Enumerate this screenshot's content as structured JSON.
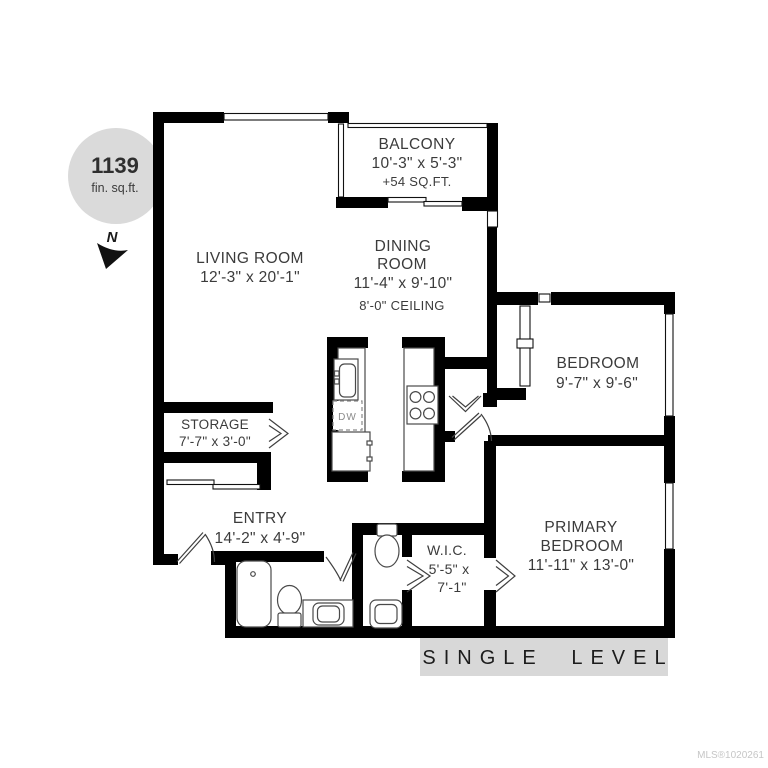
{
  "badge": {
    "area": "1139",
    "unit": "fin. sq.ft."
  },
  "compass": {
    "north": "N"
  },
  "rooms": {
    "balcony": {
      "name": "BALCONY",
      "dims": "10'-3\" x 5'-3\"",
      "extra": "+54 SQ.FT."
    },
    "living_room": {
      "name": "LIVING ROOM",
      "dims": "12'-3\" x 20'-1\""
    },
    "dining_room": {
      "name_line1": "DINING",
      "name_line2": "ROOM",
      "dims": "11'-4\" x 9'-10\"",
      "ceiling": "8'-0\" CEILING"
    },
    "bedroom": {
      "name": "BEDROOM",
      "dims": "9'-7\" x 9'-6\""
    },
    "primary_bedroom": {
      "name_line1": "PRIMARY",
      "name_line2": "BEDROOM",
      "dims": "11'-11\" x 13'-0\""
    },
    "storage": {
      "name": "STORAGE",
      "dims": "7'-7\" x 3'-0\""
    },
    "entry": {
      "name": "ENTRY",
      "dims": "14'-2\" x 4'-9\""
    },
    "wic": {
      "name": "W.I.C.",
      "dims_line1": "5'-5\" x",
      "dims_line2": "7'-1\""
    }
  },
  "kitchen": {
    "dishwasher": "DW"
  },
  "footer": {
    "level_banner": "SINGLE LEVEL",
    "watermark": "MLS®1020261"
  },
  "colors": {
    "wall": "#000000",
    "badge_bg": "#dadada",
    "banner_bg": "#d8d8d8",
    "label_text": "#3b3b3b",
    "watermark": "#c6c6c6"
  }
}
